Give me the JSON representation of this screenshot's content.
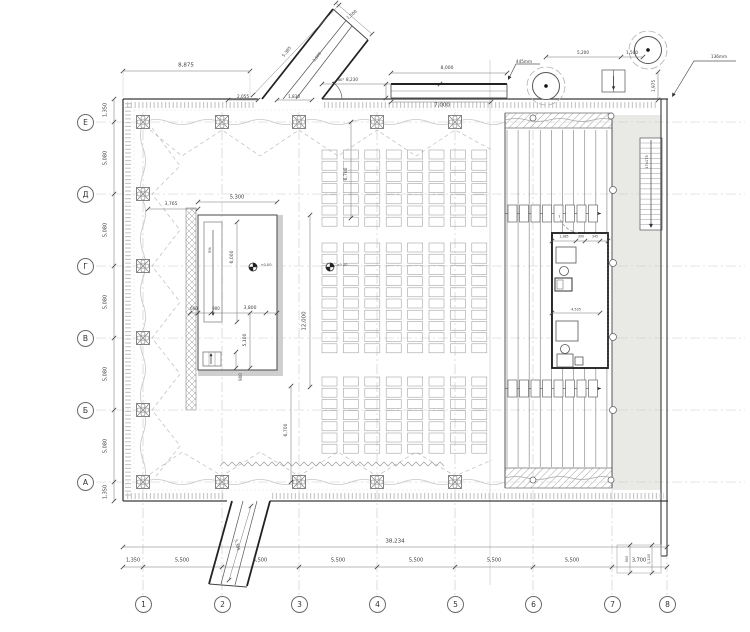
{
  "plan": {
    "title": "theatre-hall-floor-plan",
    "grid": {
      "row_labels": [
        "Е",
        "Д",
        "Г",
        "В",
        "Б",
        "А"
      ],
      "col_labels": [
        "1",
        "2",
        "3",
        "4",
        "5",
        "6",
        "7",
        "8"
      ],
      "row_spacings": [
        "1,350",
        "5,080",
        "5,080",
        "5,080",
        "5,080",
        "5,080",
        "1,350"
      ],
      "col_spacings": [
        "1,350",
        "5,500",
        "5,500",
        "5,500",
        "5,500",
        "5,500",
        "5,500",
        "3,700"
      ],
      "overall_width": "38,234"
    },
    "top_dims": {
      "left_span": "8,875",
      "opening_a": "2,055",
      "opening_b": "1,830",
      "mid_span": "8,230",
      "canopy_len": "8,000",
      "canopy_len2": "7,000",
      "canopy_note": "445mm",
      "tree_span": "5,200",
      "tree_gap": "1,500",
      "right_offset": "1,975",
      "corner_note": "136mm"
    },
    "ramp_top": {
      "width": "1,500",
      "length": "5,385",
      "inner": "3,500",
      "angle": "60°"
    },
    "ramp_bottom": {
      "length": "5,385"
    },
    "lobby": {
      "dim_a": "3,765",
      "dim_b": "5,300",
      "dim_c": "6,000",
      "slope": "5%",
      "dim_d": "600",
      "dim_e": "900",
      "dim_f": "3,800",
      "dim_g": "5,100",
      "dim_h": "900"
    },
    "hall": {
      "depth": "12,000",
      "aisle_top": "6,700",
      "aisle_bottom": "6,700",
      "level_a": "+0.00",
      "level_b": "±0.00",
      "seating": {
        "columns": 8,
        "bands": [
          7,
          10,
          7
        ]
      }
    },
    "stage": {
      "booth_dim_a": "1,385",
      "booth_dim_b": "300",
      "booth_dim_c": "345",
      "booth_dim_d": "4,535",
      "stair_note": "17x175",
      "annex_dim_a": "900",
      "annex_dim_b": "1,100"
    }
  }
}
